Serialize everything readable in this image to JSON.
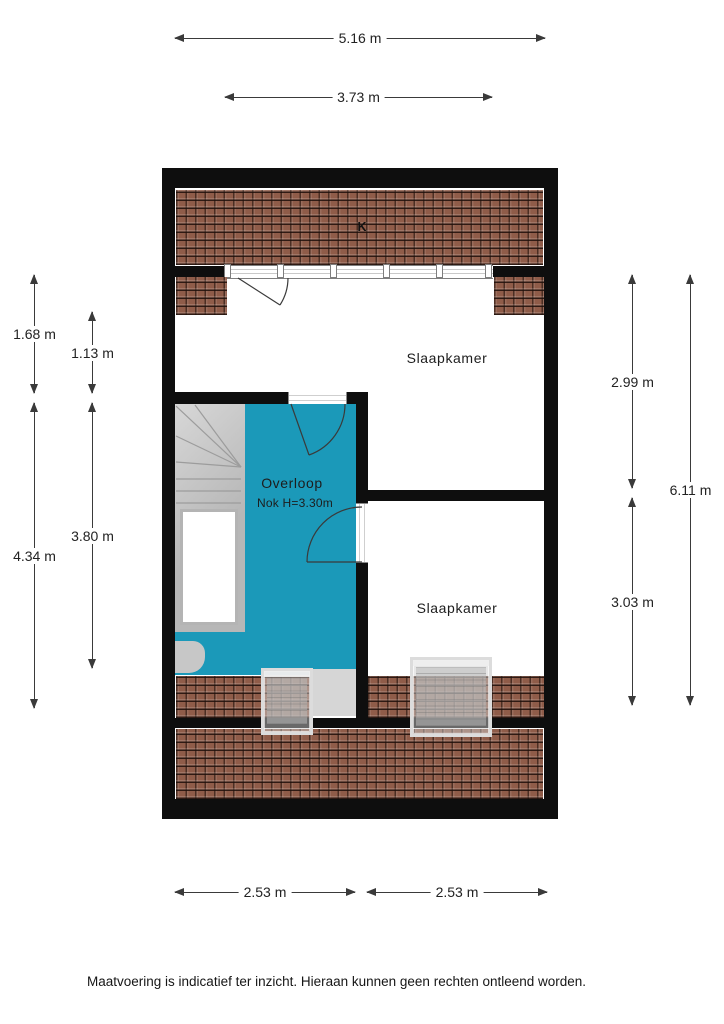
{
  "colors": {
    "wall": "#0e0e0e",
    "roof_tile": "#8f5c49",
    "overloop_fill": "#1b99b9",
    "stairs": "#c2c2c2",
    "dim": "#3a3a3a"
  },
  "floorplan": {
    "roof_ridge_label": "K",
    "rooms": {
      "bedroom1": {
        "label": "Slaapkamer"
      },
      "bedroom2": {
        "label": "Slaapkamer"
      },
      "landing": {
        "label": "Overloop",
        "ridge_height": "Nok H=3.30m"
      }
    },
    "dimensions": {
      "top": [
        {
          "label": "5.16 m"
        },
        {
          "label": "3.73 m"
        }
      ],
      "bottom": [
        {
          "label": "2.53 m"
        },
        {
          "label": "2.53 m"
        }
      ],
      "left": [
        {
          "label": "1.68 m"
        },
        {
          "label": "1.13 m"
        },
        {
          "label": "4.34 m"
        },
        {
          "label": "3.80 m"
        }
      ],
      "right": [
        {
          "label": "2.99 m"
        },
        {
          "label": "3.03 m"
        },
        {
          "label": "6.11 m"
        }
      ]
    }
  },
  "footer": {
    "disclaimer": "Maatvoering is indicatief ter inzicht. Hieraan kunnen geen rechten ontleend worden."
  }
}
